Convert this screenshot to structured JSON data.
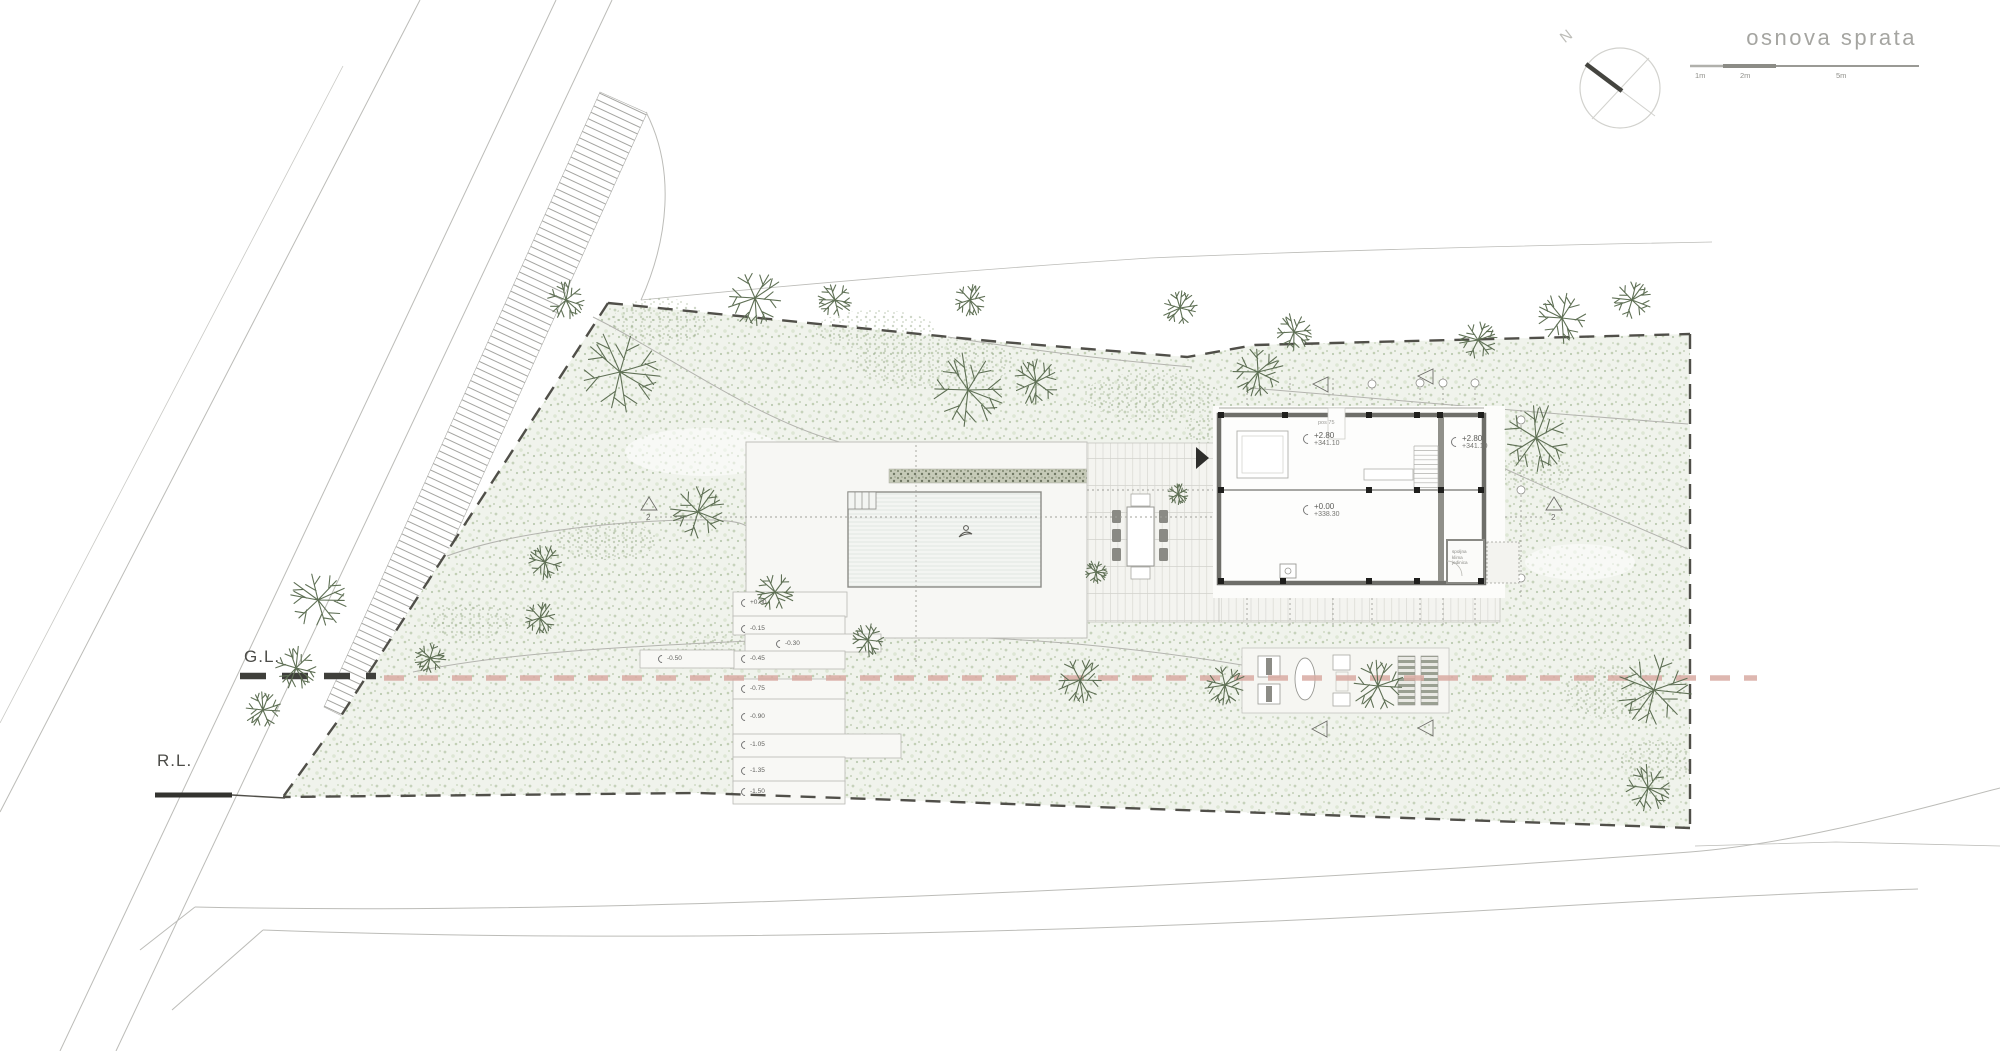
{
  "title": "osnova sprata",
  "compass": {
    "north": "N"
  },
  "scale_bar": {
    "ticks": [
      "1m",
      "2m",
      "5m"
    ]
  },
  "site": {
    "ground_line_label": "G.L.",
    "road_line_label": "R.L.",
    "section_number": "2"
  },
  "house": {
    "pos_note": "pos 75",
    "upper_room": {
      "rel": "+2.80",
      "abs": "+341.10"
    },
    "side_room": {
      "rel": "+2.80",
      "abs": "+341.10"
    },
    "ground_room": {
      "rel": "+0.00",
      "abs": "+338.30"
    },
    "ac_room": {
      "line1": "spoljna",
      "line2": "klima",
      "line3": "jedinica"
    }
  },
  "garden_steps": {
    "levels": [
      "+0.00",
      "-0.15",
      "-0.30",
      "-0.45",
      "-0.50",
      "-0.75",
      "-0.90",
      "-1.05",
      "-1.35",
      "-1.50"
    ]
  },
  "colors": {
    "section_line_pink": "#d9aba3",
    "ground_line_dark": "#3f3f3b",
    "site_speckle_green": "#c6d2bb",
    "wall_gray": "#6e6e69"
  }
}
